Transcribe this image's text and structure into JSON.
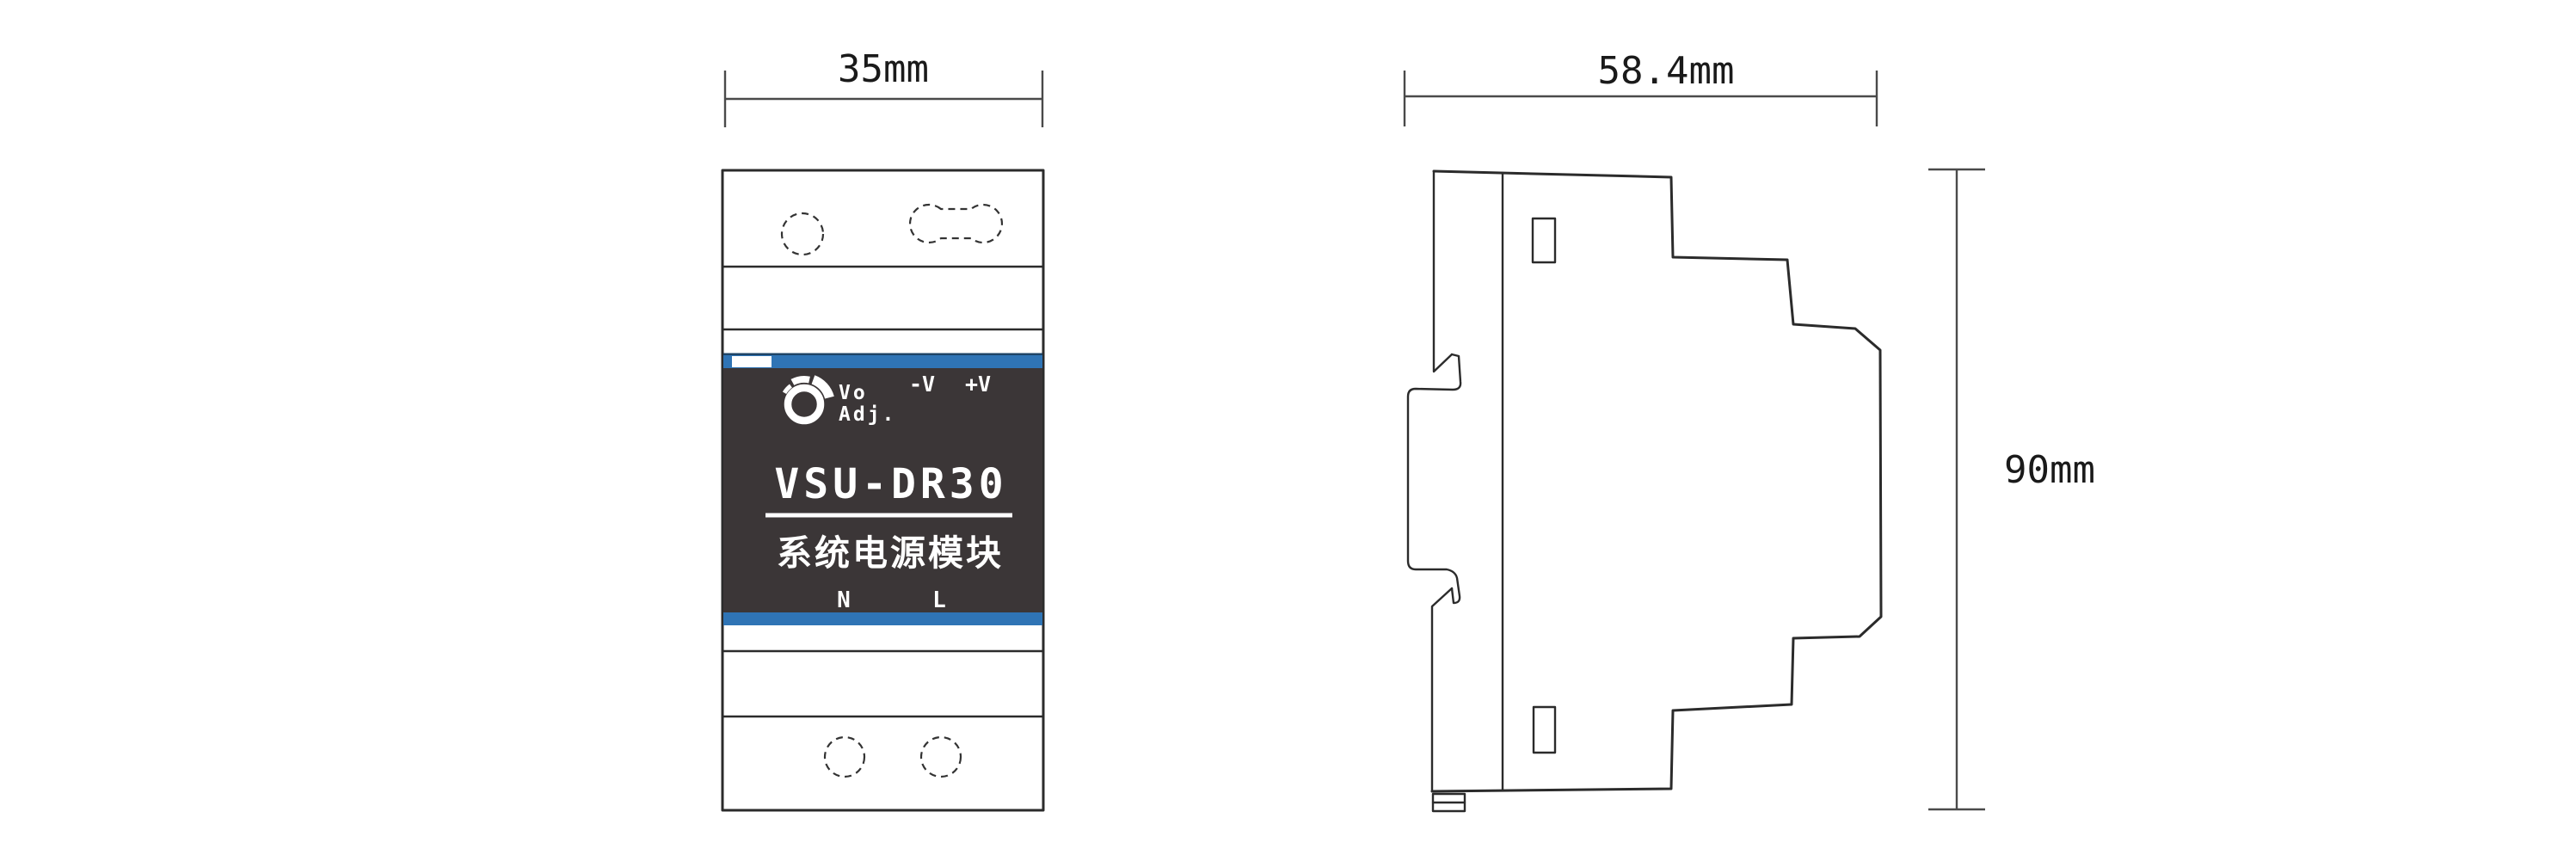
{
  "drawing": {
    "title": "VSU-DR30 DIN-rail power module dimension drawing",
    "views": [
      "front-view",
      "side-view"
    ]
  },
  "colors": {
    "stripe_blue": "#2F74B5",
    "stripe_blue_edge": "#1E4467",
    "panel_dark": "#3B3637",
    "object_line": "#2b2b2b",
    "dim_line": "#4a4a4a",
    "panel_text": "#ffffff"
  },
  "front_view": {
    "panel": {
      "knob_label_line1": "Vo",
      "knob_label_line2": "Adj.",
      "terminal_neg": "-V",
      "terminal_pos": "+V",
      "model": "VSU-DR30",
      "subtitle": "系统电源模块",
      "bottom_terminal_left": "N",
      "bottom_terminal_right": "L"
    },
    "icons": [
      "vo-adj-knob-icon"
    ]
  },
  "dimensions": {
    "front_width": "35mm",
    "side_depth": "58.4mm",
    "side_height": "90mm"
  }
}
